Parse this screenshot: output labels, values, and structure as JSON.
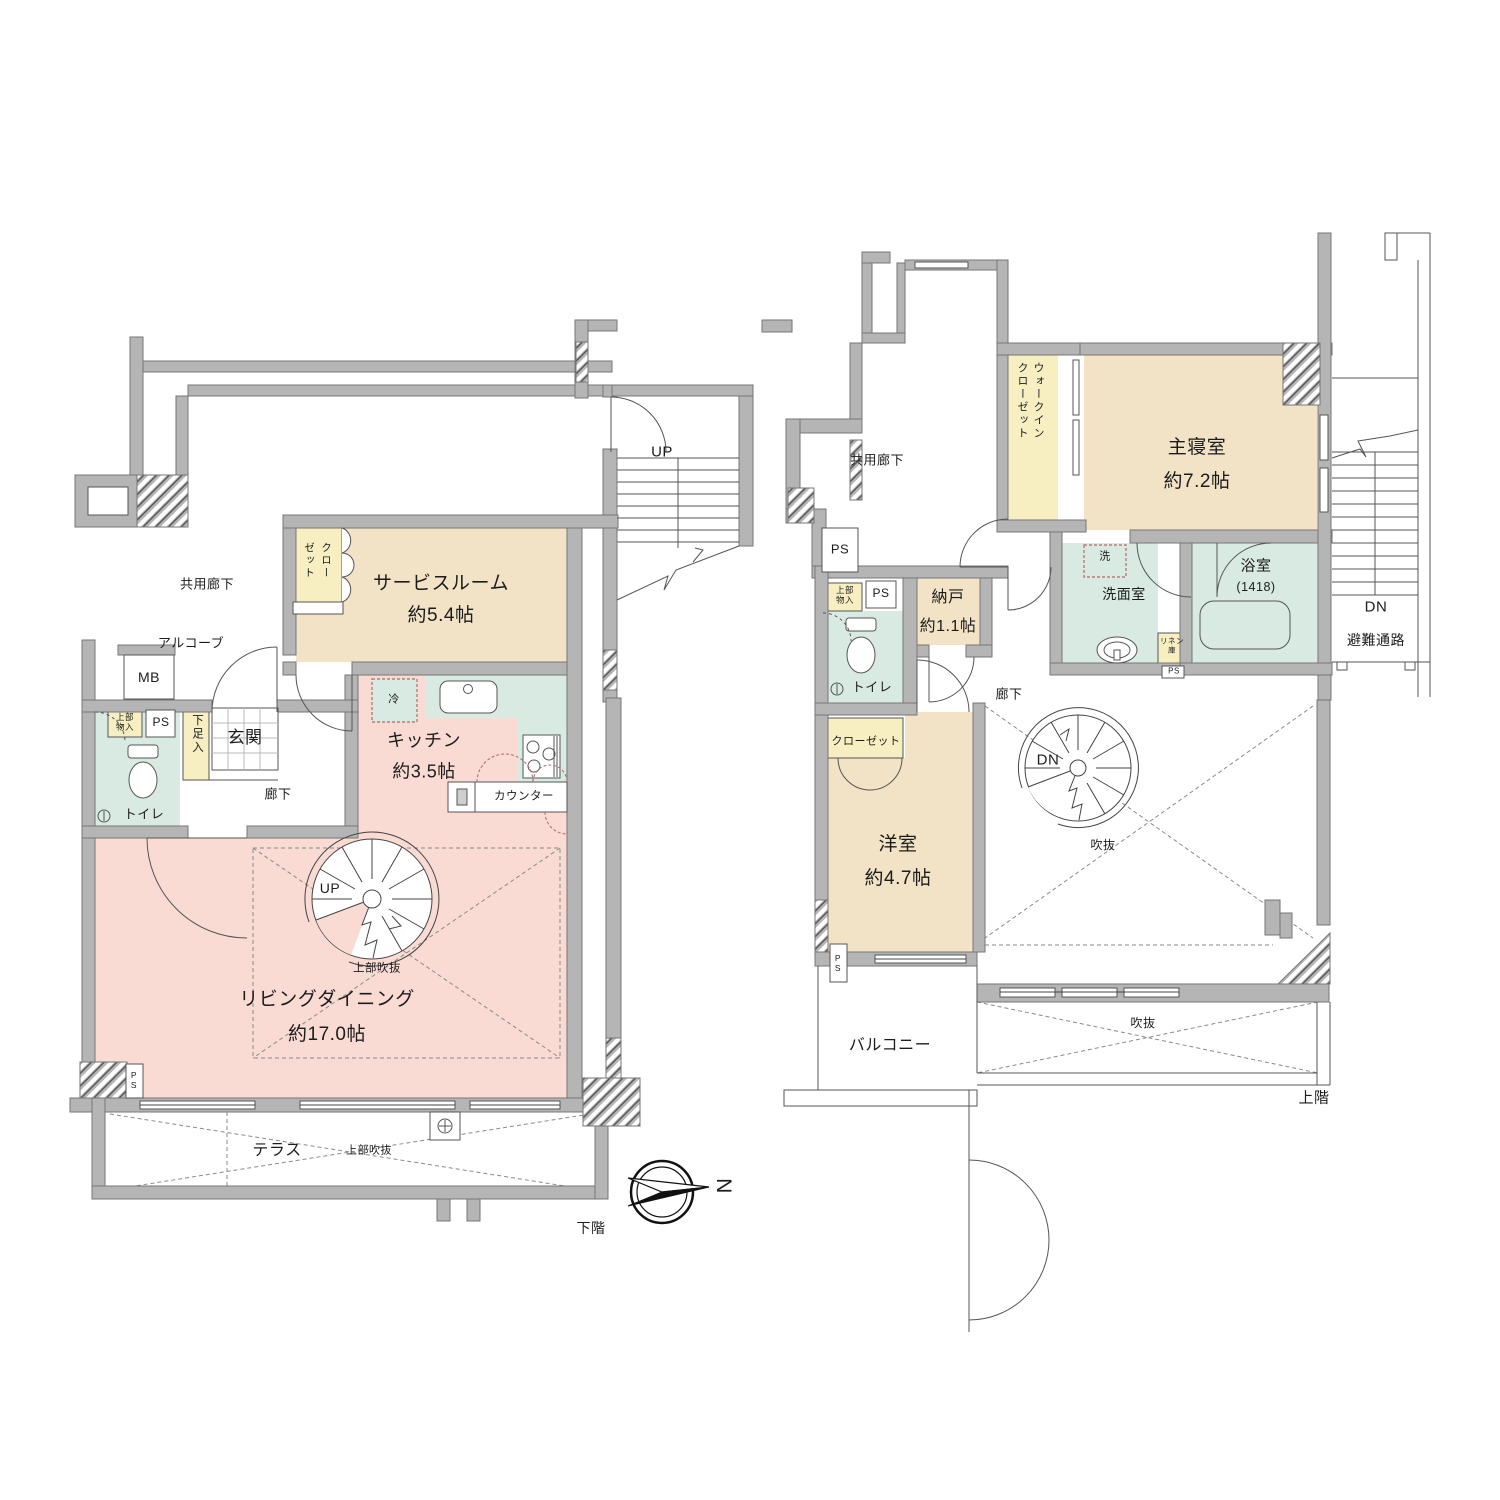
{
  "title": "マンション間取り図（メゾネット）",
  "compass": {
    "label": "N"
  },
  "colors": {
    "wall": "#b5b5b5",
    "wall_edge": "#767676",
    "room_beige": "#f2e3c6",
    "closet_yellow": "#f7efc2",
    "ldk_pink": "#f9dbd4",
    "wet_green": "#d9eae2",
    "void_dash": "#8a8a8a",
    "appliance_dash": "#b06a6a"
  },
  "floors": [
    {
      "id": "lower",
      "caption": "下階",
      "rooms": [
        "共用廊下",
        "アルコーブ",
        "MB",
        "PS",
        "上部物入",
        "トイレ",
        "下足入",
        "玄関",
        "廊下",
        "クローゼット",
        "サービスルーム 約5.4帖",
        "キッチン 約3.5帖",
        "カウンター",
        "冷",
        "リビングダイニング 約17.0帖",
        "上部吹抜",
        "テラス"
      ]
    },
    {
      "id": "upper",
      "caption": "上階",
      "rooms": [
        "共用廊下",
        "PS",
        "上部物入",
        "トイレ",
        "クローゼット",
        "納戸 約1.1帖",
        "ウォークインクローゼット",
        "主寝室 約7.2帖",
        "洗",
        "洗面室",
        "浴室(1418)",
        "リネン庫",
        "廊下",
        "洋室 約4.7帖",
        "吹抜",
        "バルコニー",
        "避難通路"
      ]
    }
  ],
  "labels": [
    {
      "id": "label-kyoyo-roka-floor1",
      "text": "共用廊下",
      "x": 207,
      "y": 585,
      "s": 13
    },
    {
      "id": "label-up-stairs",
      "text": "UP",
      "x": 662,
      "y": 452,
      "s": 15
    },
    {
      "id": "label-closet-service",
      "text": "クローゼット",
      "x": 300,
      "y": 542,
      "s": 10.5,
      "v": 1,
      "h": 48,
      "lh": 17
    },
    {
      "id": "label-service-room",
      "text": "サービスルーム",
      "x": 441,
      "y": 584,
      "s": 19
    },
    {
      "id": "label-service-size",
      "text": "約5.4帖",
      "x": 441,
      "y": 616,
      "s": 19
    },
    {
      "id": "label-alcove",
      "text": "アルコーブ",
      "x": 191,
      "y": 644,
      "s": 13
    },
    {
      "id": "label-mb",
      "text": "MB",
      "x": 149,
      "y": 677,
      "s": 14
    },
    {
      "id": "label-joubu-monoire-1",
      "text": "上部\n物入",
      "x": 125,
      "y": 723,
      "s": 8.5
    },
    {
      "id": "label-ps-1",
      "text": "PS",
      "x": 161,
      "y": 723,
      "s": 12
    },
    {
      "id": "label-toilet-1",
      "text": "トイレ",
      "x": 144,
      "y": 815,
      "s": 13
    },
    {
      "id": "label-shitasokuire",
      "text": "下足入",
      "x": 190,
      "y": 714,
      "s": 11.5,
      "v": 1,
      "h": 62,
      "lh": 14
    },
    {
      "id": "label-genkan",
      "text": "玄関",
      "x": 245,
      "y": 738,
      "s": 17
    },
    {
      "id": "label-roka-1",
      "text": "廊下",
      "x": 278,
      "y": 795,
      "s": 13
    },
    {
      "id": "label-rei",
      "text": "冷",
      "x": 394,
      "y": 700,
      "s": 11
    },
    {
      "id": "label-kitchen",
      "text": "キッチン",
      "x": 424,
      "y": 741,
      "s": 18
    },
    {
      "id": "label-kitchen-size",
      "text": "約3.5帖",
      "x": 424,
      "y": 772,
      "s": 18
    },
    {
      "id": "label-counter",
      "text": "カウンター",
      "x": 524,
      "y": 797,
      "s": 11.5
    },
    {
      "id": "label-up-spiral",
      "text": "UP",
      "x": 330,
      "y": 888,
      "s": 14
    },
    {
      "id": "label-joubu-fukinuke-ld",
      "text": "上部吹抜",
      "x": 377,
      "y": 969,
      "s": 11.5
    },
    {
      "id": "label-living-dining",
      "text": "リビングダイニング",
      "x": 327,
      "y": 1000,
      "s": 19
    },
    {
      "id": "label-living-size",
      "text": "約17.0帖",
      "x": 327,
      "y": 1035,
      "s": 19
    },
    {
      "id": "label-ps-2",
      "text": "P\nS",
      "x": 134,
      "y": 1081,
      "s": 8.5
    },
    {
      "id": "label-terrace",
      "text": "テラス",
      "x": 277,
      "y": 1151,
      "s": 16
    },
    {
      "id": "label-joubu-fukinuke-terrace",
      "text": "上部吹抜",
      "x": 369,
      "y": 1151,
      "s": 11
    },
    {
      "id": "label-shimokai",
      "text": "下階",
      "x": 591,
      "y": 1228,
      "s": 14
    },
    {
      "id": "label-kyoyo-roka-floor2",
      "text": "共用廊下",
      "x": 877,
      "y": 461,
      "s": 13
    },
    {
      "id": "label-wic",
      "text": "ウォークインクローゼット",
      "x": 1014,
      "y": 362,
      "s": 11,
      "v": 1,
      "h": 88,
      "lh": 16
    },
    {
      "id": "label-shushinshitsu",
      "text": "主寝室",
      "x": 1197,
      "y": 448,
      "s": 19
    },
    {
      "id": "label-shushin-size",
      "text": "約7.2帖",
      "x": 1197,
      "y": 482,
      "s": 19
    },
    {
      "id": "label-ps-3",
      "text": "PS",
      "x": 840,
      "y": 550,
      "s": 13
    },
    {
      "id": "label-joubu-monoire-2",
      "text": "上部\n物入",
      "x": 845,
      "y": 596,
      "s": 8.5
    },
    {
      "id": "label-ps-4",
      "text": "PS",
      "x": 881,
      "y": 594,
      "s": 12
    },
    {
      "id": "label-nando",
      "text": "納戸",
      "x": 948,
      "y": 598,
      "s": 16
    },
    {
      "id": "label-nando-size",
      "text": "約1.1帖",
      "x": 948,
      "y": 627,
      "s": 16
    },
    {
      "id": "label-sen",
      "text": "洗",
      "x": 1105,
      "y": 557,
      "s": 11
    },
    {
      "id": "label-senmenshitsu",
      "text": "洗面室",
      "x": 1124,
      "y": 594,
      "s": 14
    },
    {
      "id": "label-yokushitsu",
      "text": "浴室",
      "x": 1256,
      "y": 566,
      "s": 15
    },
    {
      "id": "label-yokushitsu-size",
      "text": "(1418)",
      "x": 1256,
      "y": 587,
      "s": 12.5
    },
    {
      "id": "label-linen",
      "text": "リネン\n庫",
      "x": 1172,
      "y": 646,
      "s": 7.5
    },
    {
      "id": "label-ps-5",
      "text": "PS",
      "x": 1174,
      "y": 671,
      "s": 8
    },
    {
      "id": "label-dn-ext",
      "text": "DN",
      "x": 1376,
      "y": 607,
      "s": 15
    },
    {
      "id": "label-hinan-tsuro",
      "text": "避難通路",
      "x": 1376,
      "y": 640,
      "s": 14
    },
    {
      "id": "label-toilet-2",
      "text": "トイレ",
      "x": 872,
      "y": 688,
      "s": 13
    },
    {
      "id": "label-roka-2",
      "text": "廊下",
      "x": 1009,
      "y": 695,
      "s": 13
    },
    {
      "id": "label-closet-2",
      "text": "クローゼット",
      "x": 866,
      "y": 742,
      "s": 11
    },
    {
      "id": "label-dn-spiral",
      "text": "DN",
      "x": 1048,
      "y": 760,
      "s": 15
    },
    {
      "id": "label-yoshitsu",
      "text": "洋室",
      "x": 898,
      "y": 845,
      "s": 19
    },
    {
      "id": "label-yoshitsu-size",
      "text": "約4.7帖",
      "x": 898,
      "y": 879,
      "s": 19
    },
    {
      "id": "label-fukinuke-1",
      "text": "吹抜",
      "x": 1103,
      "y": 846,
      "s": 12
    },
    {
      "id": "label-ps-6",
      "text": "P\nS",
      "x": 838,
      "y": 964,
      "s": 8.5
    },
    {
      "id": "label-balcony",
      "text": "バルコニー",
      "x": 890,
      "y": 1046,
      "s": 16
    },
    {
      "id": "label-fukinuke-2",
      "text": "吹抜",
      "x": 1143,
      "y": 1024,
      "s": 12
    },
    {
      "id": "label-joukai",
      "text": "上階",
      "x": 1314,
      "y": 1098,
      "s": 15
    },
    {
      "id": "label-compass-n",
      "text": "N",
      "x": 723,
      "y": 1186,
      "s": 21,
      "rot": 90
    }
  ]
}
